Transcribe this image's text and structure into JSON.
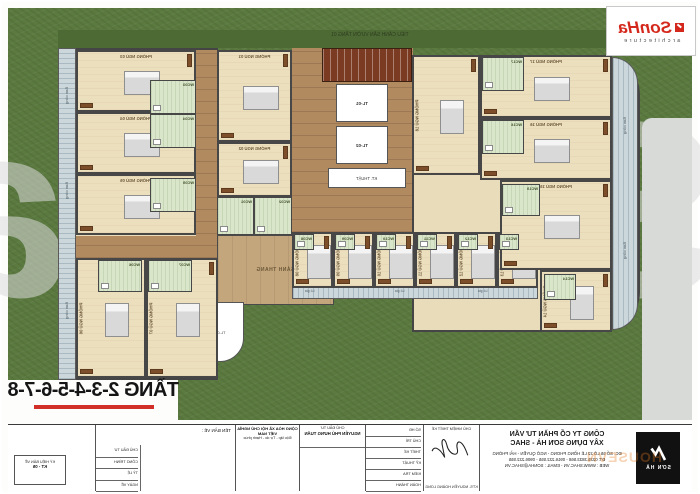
{
  "meta": {
    "sheet_title": "TẦNG 2-3-4-5-6-7-8",
    "top_caption": "TIỂU CẢNH SÂN VƯỜN TẦNG 01"
  },
  "logo": {
    "brand": "SonHa",
    "sub": "architecture"
  },
  "watermark": {
    "big": "SonHa",
    "badge": "HOUSEVN"
  },
  "plan": {
    "corridor_label": "SẢNH THANG",
    "tech_label": "KT. THUẬT",
    "elevators": [
      "TL-01",
      "TL-02"
    ],
    "stair_label": "TL-03",
    "balcony_label": "Ban công",
    "loggia_label": "Lô gia",
    "rooms": [
      {
        "label": "PHÒNG NGỦ 01",
        "x": 217,
        "y": 50,
        "w": 75,
        "h": 92,
        "bed": "h",
        "lp": "top"
      },
      {
        "label": "PHÒNG NGỦ 02",
        "x": 217,
        "y": 142,
        "w": 75,
        "h": 55,
        "bed": "h",
        "lp": "top"
      },
      {
        "label": "PHÒNG NGỦ 03",
        "x": 76,
        "y": 50,
        "w": 120,
        "h": 62,
        "bed": "h",
        "lp": "top"
      },
      {
        "label": "PHÒNG NGỦ 04",
        "x": 76,
        "y": 112,
        "w": 120,
        "h": 62,
        "bed": "h",
        "lp": "top"
      },
      {
        "label": "PHÒNG NGỦ 05",
        "x": 76,
        "y": 174,
        "w": 120,
        "h": 61,
        "bed": "h",
        "lp": "top"
      },
      {
        "label": "PHÒNG NGỦ 06",
        "x": 76,
        "y": 258,
        "w": 70,
        "h": 120,
        "bed": "v",
        "lp": "side"
      },
      {
        "label": "PHÒNG NGỦ 07",
        "x": 146,
        "y": 258,
        "w": 72,
        "h": 120,
        "bed": "v",
        "lp": "side"
      },
      {
        "label": "PHÒNG NGỦ 08",
        "x": 292,
        "y": 232,
        "w": 41,
        "h": 56,
        "bed": "v",
        "lp": "side"
      },
      {
        "label": "PHÒNG NGỦ 09",
        "x": 333,
        "y": 232,
        "w": 41,
        "h": 56,
        "bed": "v",
        "lp": "side"
      },
      {
        "label": "PHÒNG NGỦ 10",
        "x": 374,
        "y": 232,
        "w": 41,
        "h": 56,
        "bed": "v",
        "lp": "side"
      },
      {
        "label": "PHÒNG NGỦ 11",
        "x": 415,
        "y": 232,
        "w": 41,
        "h": 56,
        "bed": "v",
        "lp": "side"
      },
      {
        "label": "PHÒNG NGỦ 12",
        "x": 456,
        "y": 232,
        "w": 41,
        "h": 56,
        "bed": "v",
        "lp": "side"
      },
      {
        "label": "PHÒNG NGỦ 13",
        "x": 497,
        "y": 232,
        "w": 41,
        "h": 56,
        "bed": "v",
        "lp": "side"
      },
      {
        "label": "PHÒNG NGỦ 14",
        "x": 540,
        "y": 270,
        "w": 72,
        "h": 62,
        "bed": "v",
        "lp": "side"
      },
      {
        "label": "PHÒNG NGỦ 15",
        "x": 500,
        "y": 180,
        "w": 112,
        "h": 90,
        "bed": "h",
        "lp": "top"
      },
      {
        "label": "PHÒNG NGỦ 16",
        "x": 480,
        "y": 118,
        "w": 132,
        "h": 62,
        "bed": "h",
        "lp": "top"
      },
      {
        "label": "PHÒNG NGỦ 17",
        "x": 480,
        "y": 55,
        "w": 132,
        "h": 63,
        "bed": "h",
        "lp": "top"
      },
      {
        "label": "PHÒNG NGỦ 18",
        "x": 412,
        "y": 55,
        "w": 68,
        "h": 120,
        "bed": "v",
        "lp": "side"
      }
    ],
    "wcs": [
      {
        "label": "WC01",
        "x": 217,
        "y": 197,
        "w": 37,
        "h": 38
      },
      {
        "label": "WC02",
        "x": 254,
        "y": 197,
        "w": 38,
        "h": 38
      },
      {
        "label": "WC03",
        "x": 150,
        "y": 80,
        "w": 46,
        "h": 34
      },
      {
        "label": "WC04",
        "x": 150,
        "y": 114,
        "w": 46,
        "h": 34
      },
      {
        "label": "WC05",
        "x": 150,
        "y": 178,
        "w": 46,
        "h": 34
      },
      {
        "label": "WC06",
        "x": 98,
        "y": 260,
        "w": 44,
        "h": 32
      },
      {
        "label": "WC07",
        "x": 148,
        "y": 260,
        "w": 44,
        "h": 32
      },
      {
        "label": "WC08",
        "x": 294,
        "y": 234,
        "w": 20,
        "h": 16
      },
      {
        "label": "WC09",
        "x": 335,
        "y": 234,
        "w": 20,
        "h": 16
      },
      {
        "label": "WC10",
        "x": 376,
        "y": 234,
        "w": 20,
        "h": 16
      },
      {
        "label": "WC11",
        "x": 417,
        "y": 234,
        "w": 20,
        "h": 16
      },
      {
        "label": "WC12",
        "x": 458,
        "y": 234,
        "w": 20,
        "h": 16
      },
      {
        "label": "WC13",
        "x": 499,
        "y": 234,
        "w": 20,
        "h": 16
      },
      {
        "label": "WC14",
        "x": 544,
        "y": 274,
        "w": 32,
        "h": 26
      },
      {
        "label": "WC15",
        "x": 502,
        "y": 184,
        "w": 38,
        "h": 32
      },
      {
        "label": "WC16",
        "x": 482,
        "y": 120,
        "w": 42,
        "h": 34
      },
      {
        "label": "WC17",
        "x": 482,
        "y": 57,
        "w": 42,
        "h": 34
      }
    ],
    "balcony_positions": [
      {
        "x": 59,
        "y": 80
      },
      {
        "x": 59,
        "y": 175
      },
      {
        "x": 59,
        "y": 295
      },
      {
        "x": 617,
        "y": 110
      },
      {
        "x": 617,
        "y": 235
      }
    ],
    "loggia_positions": [
      {
        "x": 305,
        "y": 289
      },
      {
        "x": 395,
        "y": 289
      },
      {
        "x": 478,
        "y": 289
      }
    ]
  },
  "titleblock": {
    "company": {
      "name1": "CÔNG TY CỔ PHẦN TƯ VẤN",
      "name2": "XÂY DỰNG SƠN HÀ - SHAC",
      "address": "ĐC: SỐ 55 LÔ 22 LÊ HỒNG PHONG - NGÔ QUYỀN - HẢI PHÒNG",
      "phone": "ĐT: 0225.3833.568 - 0916.222.555 - 0906.222.555",
      "web": "WEB : WWW.SHAC.VN - EMAIL : SONHA@SHAC.VN",
      "logo_text": "SƠN HÀ"
    },
    "signature": {
      "title": "CHỦ NHIỆM THIẾT KẾ",
      "name": "KTS. NGUYỄN HOÀNG LONG"
    },
    "roles": [
      "SỐ HĐ",
      "CHỦ TRÌ",
      "THIẾT KẾ",
      "KỸ THUẬT",
      "KIỂM TRA",
      "HOÀN THÀNH"
    ],
    "client_label": "CHỦ ĐẦU TƯ",
    "client_name": "NGUYỄN PHÚ HƯNG TUẤN",
    "republic1": "CỘNG HÒA XÃ HỘI CHỦ NGHĨA VIỆT NAM",
    "republic2": "Độc lập - Tự do - Hạnh phúc",
    "info_rows": [
      "CHỦ ĐẦU TƯ",
      "CÔNG TRÌNH",
      "TỶ LỆ",
      "NGÀY VẼ"
    ],
    "drawing_label": "TÊN BẢN VẼ :",
    "sheet_box1": "KÝ HIỆU BẢN VẼ",
    "sheet_box2": "KT - 05"
  }
}
